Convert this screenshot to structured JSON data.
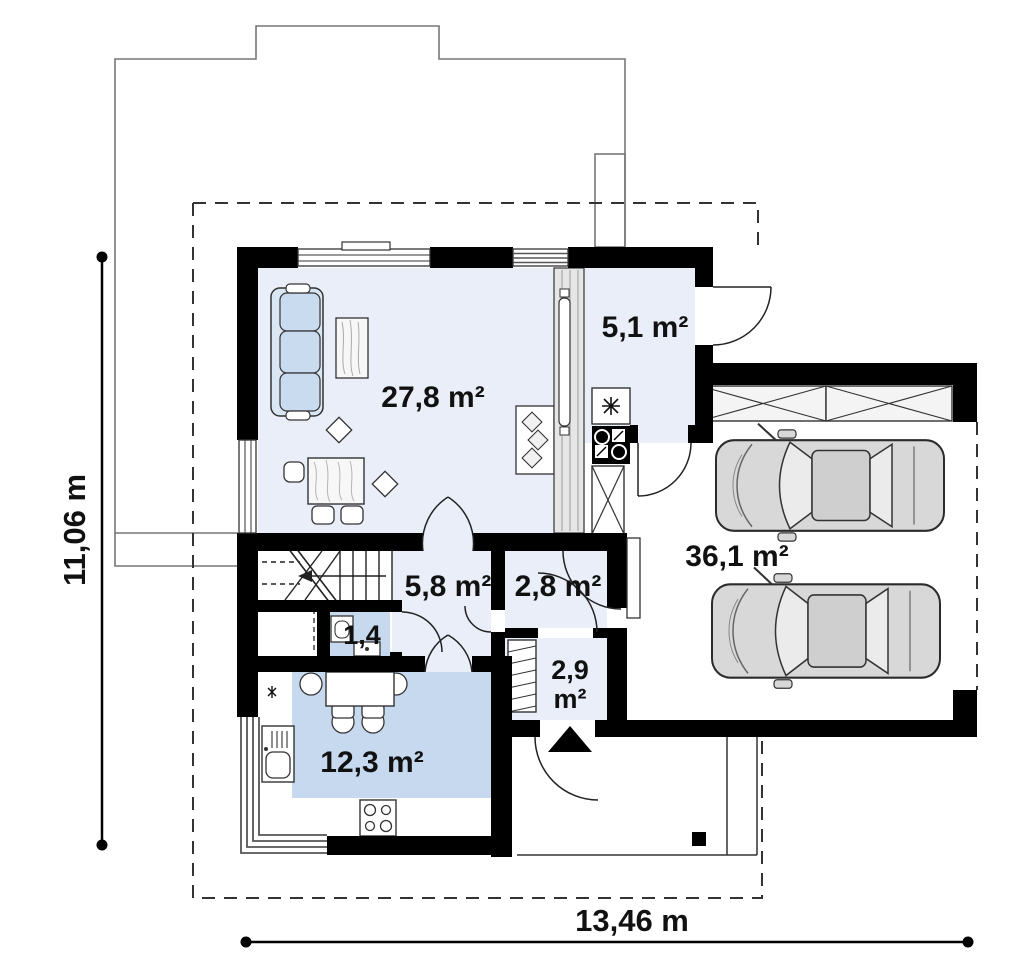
{
  "plan": {
    "rooms": {
      "living": {
        "area_label": "27,8 m²"
      },
      "boiler": {
        "area_label": "5,1 m²"
      },
      "hall": {
        "area_label": "5,8 m²"
      },
      "corridor": {
        "area_label": "2,8 m²"
      },
      "wc": {
        "area_label": "1,4"
      },
      "vestibule": {
        "area_value": "2,9",
        "area_unit": "m²"
      },
      "kitchen": {
        "area_label": "12,3 m²"
      },
      "garage": {
        "area_label": "36,1 m²"
      }
    },
    "dimensions": {
      "vertical_label": "11,06 m",
      "horizontal_label": "13,46 m"
    },
    "colors": {
      "wall": "#000000",
      "floor_light": "#e9eef8",
      "floor_blue": "#c6d9ef",
      "sofa_fill": "#c9dbef",
      "car_body": "#d8d8d8",
      "upper_floor_outline": "#777777"
    }
  }
}
